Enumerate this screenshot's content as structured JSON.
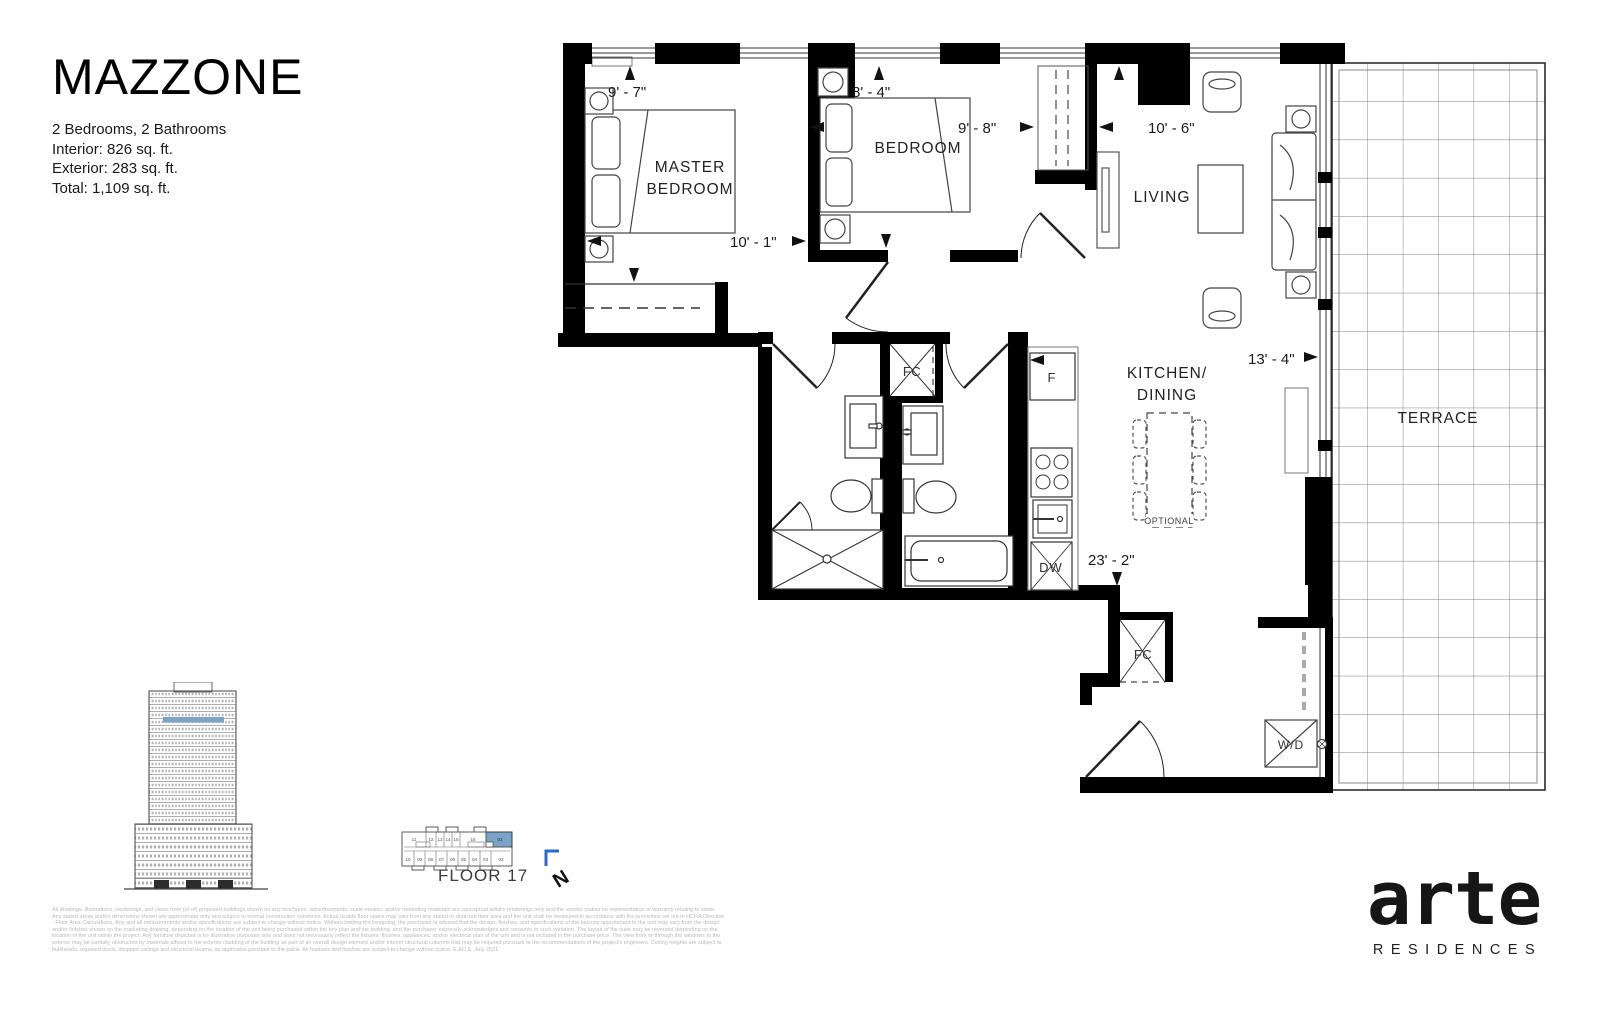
{
  "header": {
    "title": "MAZZONE",
    "spec_1": "2 Bedrooms, 2 Bathrooms",
    "spec_2": "Interior: 826 sq. ft.",
    "spec_3": "Exterior: 283 sq. ft.",
    "spec_4": "Total: 1,109 sq. ft."
  },
  "plan": {
    "rooms": {
      "master_1": "MASTER",
      "master_2": "BEDROOM",
      "bedroom": "BEDROOM",
      "living": "LIVING",
      "kitchen_1": "KITCHEN/",
      "kitchen_2": "DINING",
      "terrace": "TERRACE"
    },
    "fixtures": {
      "fc": "FC",
      "fridge": "F",
      "dishwasher": "DW",
      "washer_dryer": "W/D",
      "optional": "OPTIONAL"
    },
    "dims": {
      "master_width": "9' - 7\"",
      "bedroom_width": "8' - 4\"",
      "bedroom_depth": "9' - 8\"",
      "master_depth": "10' - 1\"",
      "living_width": "10' - 6\"",
      "kitchen_width": "13' - 4\"",
      "suite_depth": "23' - 2\""
    }
  },
  "locator": {
    "floor_label": "FLOOR 17",
    "north": "N",
    "highlighted_unit": "01",
    "units_top": [
      "11",
      "12",
      "13",
      "14",
      "15",
      "16",
      "01"
    ],
    "units_bottom": [
      "10",
      "09",
      "08",
      "07",
      "06",
      "05",
      "04",
      "03",
      "02"
    ]
  },
  "branding": {
    "name": "arte",
    "tagline": "RESIDENCES"
  },
  "legal": {
    "lines": [
      "All drawings, illustrations, renderings, and views from (or of) proposed buildings shown on any brochures, advertisements, scale models, and/or marketing materials are conceptual artist's renderings only and the vendor makes no representation or warranty relating to same.",
      "Any stated areas and/or dimensions shown are approximate only and subject to normal construction variances. Actual usable floor space may vary from any stated or depicted floor area and the unit shall be measured in accordance with the provisions set out in HCRA Directive",
      "- Floor Area Calculations. Any and all measurements and/or specifications are subject to change without notice. Without limiting the foregoing, the purchaser is advised that the design, finishes, and specifications of the balcony appurtenant to the unit may vary from the design",
      "and/or finishes shown on the marketing drawing, depending on the location of the unit being purchased within the key plan and the building, and the purchaser expressly acknowledges and consents to such variation. The layout of the suite may be reversed depending on the",
      "location of the unit within the project. Any furniture depicted is for illustration purposes only and does not necessarily reflect the fixtures, finishes, appliances, and/or electrical plan of the unit and is not included in the purchase price. The view from or through the windows to the",
      "exterior may be partially obstructed by materials affixed to the exterior cladding of the building as part of an overall design element and/or interior structural columns that may be required pursuant to the recommendations of the project's engineers. Ceiling heights are subject to",
      "bulkheads, exposed ducts, dropped ceilings and structural beams, as applicable pursuant to the plans. All features and finishes are subject to change without notice. E.&O.E. July 2021."
    ]
  },
  "colors": {
    "highlight_blue": "#7ba3c8",
    "north_blue": "#2a67cf",
    "wall_black": "#000000"
  }
}
